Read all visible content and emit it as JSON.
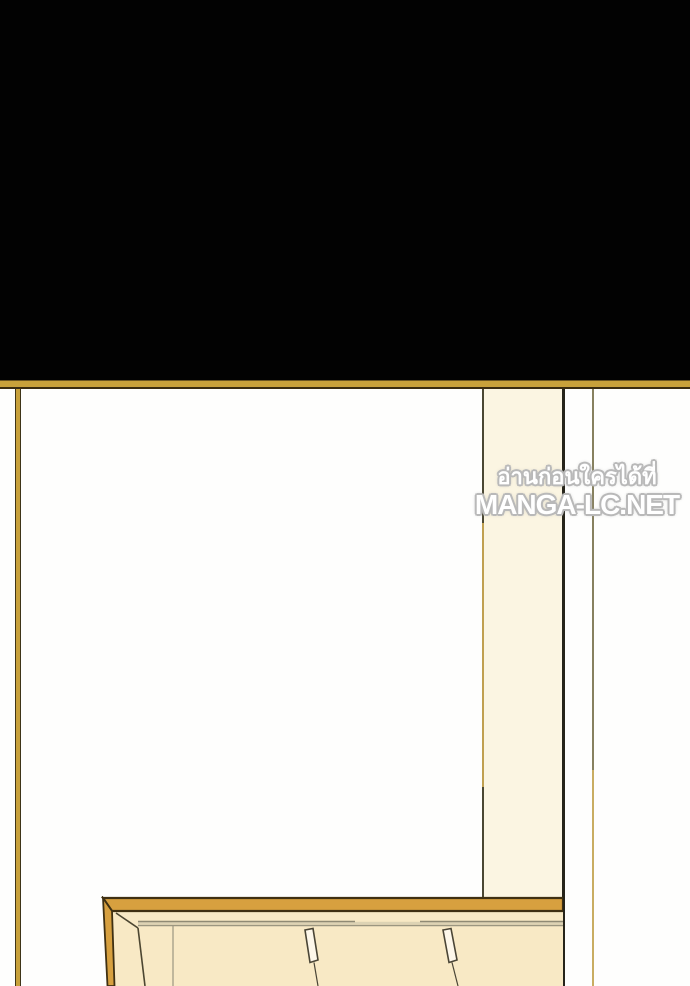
{
  "page": {
    "kind": "webtoon panel",
    "description": "black panel above, line-art room interior below with wooden table entering from bottom"
  },
  "watermark": {
    "line1": "อ่านก่อนใครได้ที่",
    "line2": "MANGA-LC.NET"
  },
  "palette": {
    "panel_black": "#020202",
    "divider_gold": "#c8a13b",
    "wall_white": "#fefefd",
    "pillar_cream": "#fbf5e2",
    "trim_dark": "#3e3418",
    "edge_olive": "#87815f",
    "edge_gold": "#c9ad62",
    "table_amber": "#d7a03f",
    "table_outline": "#3f3012",
    "table_surface": "#f8e9c5",
    "peg_fill": "#fdf7ea",
    "watermark_fill": "#ffffff",
    "watermark_outline": "#b9b9b9"
  }
}
